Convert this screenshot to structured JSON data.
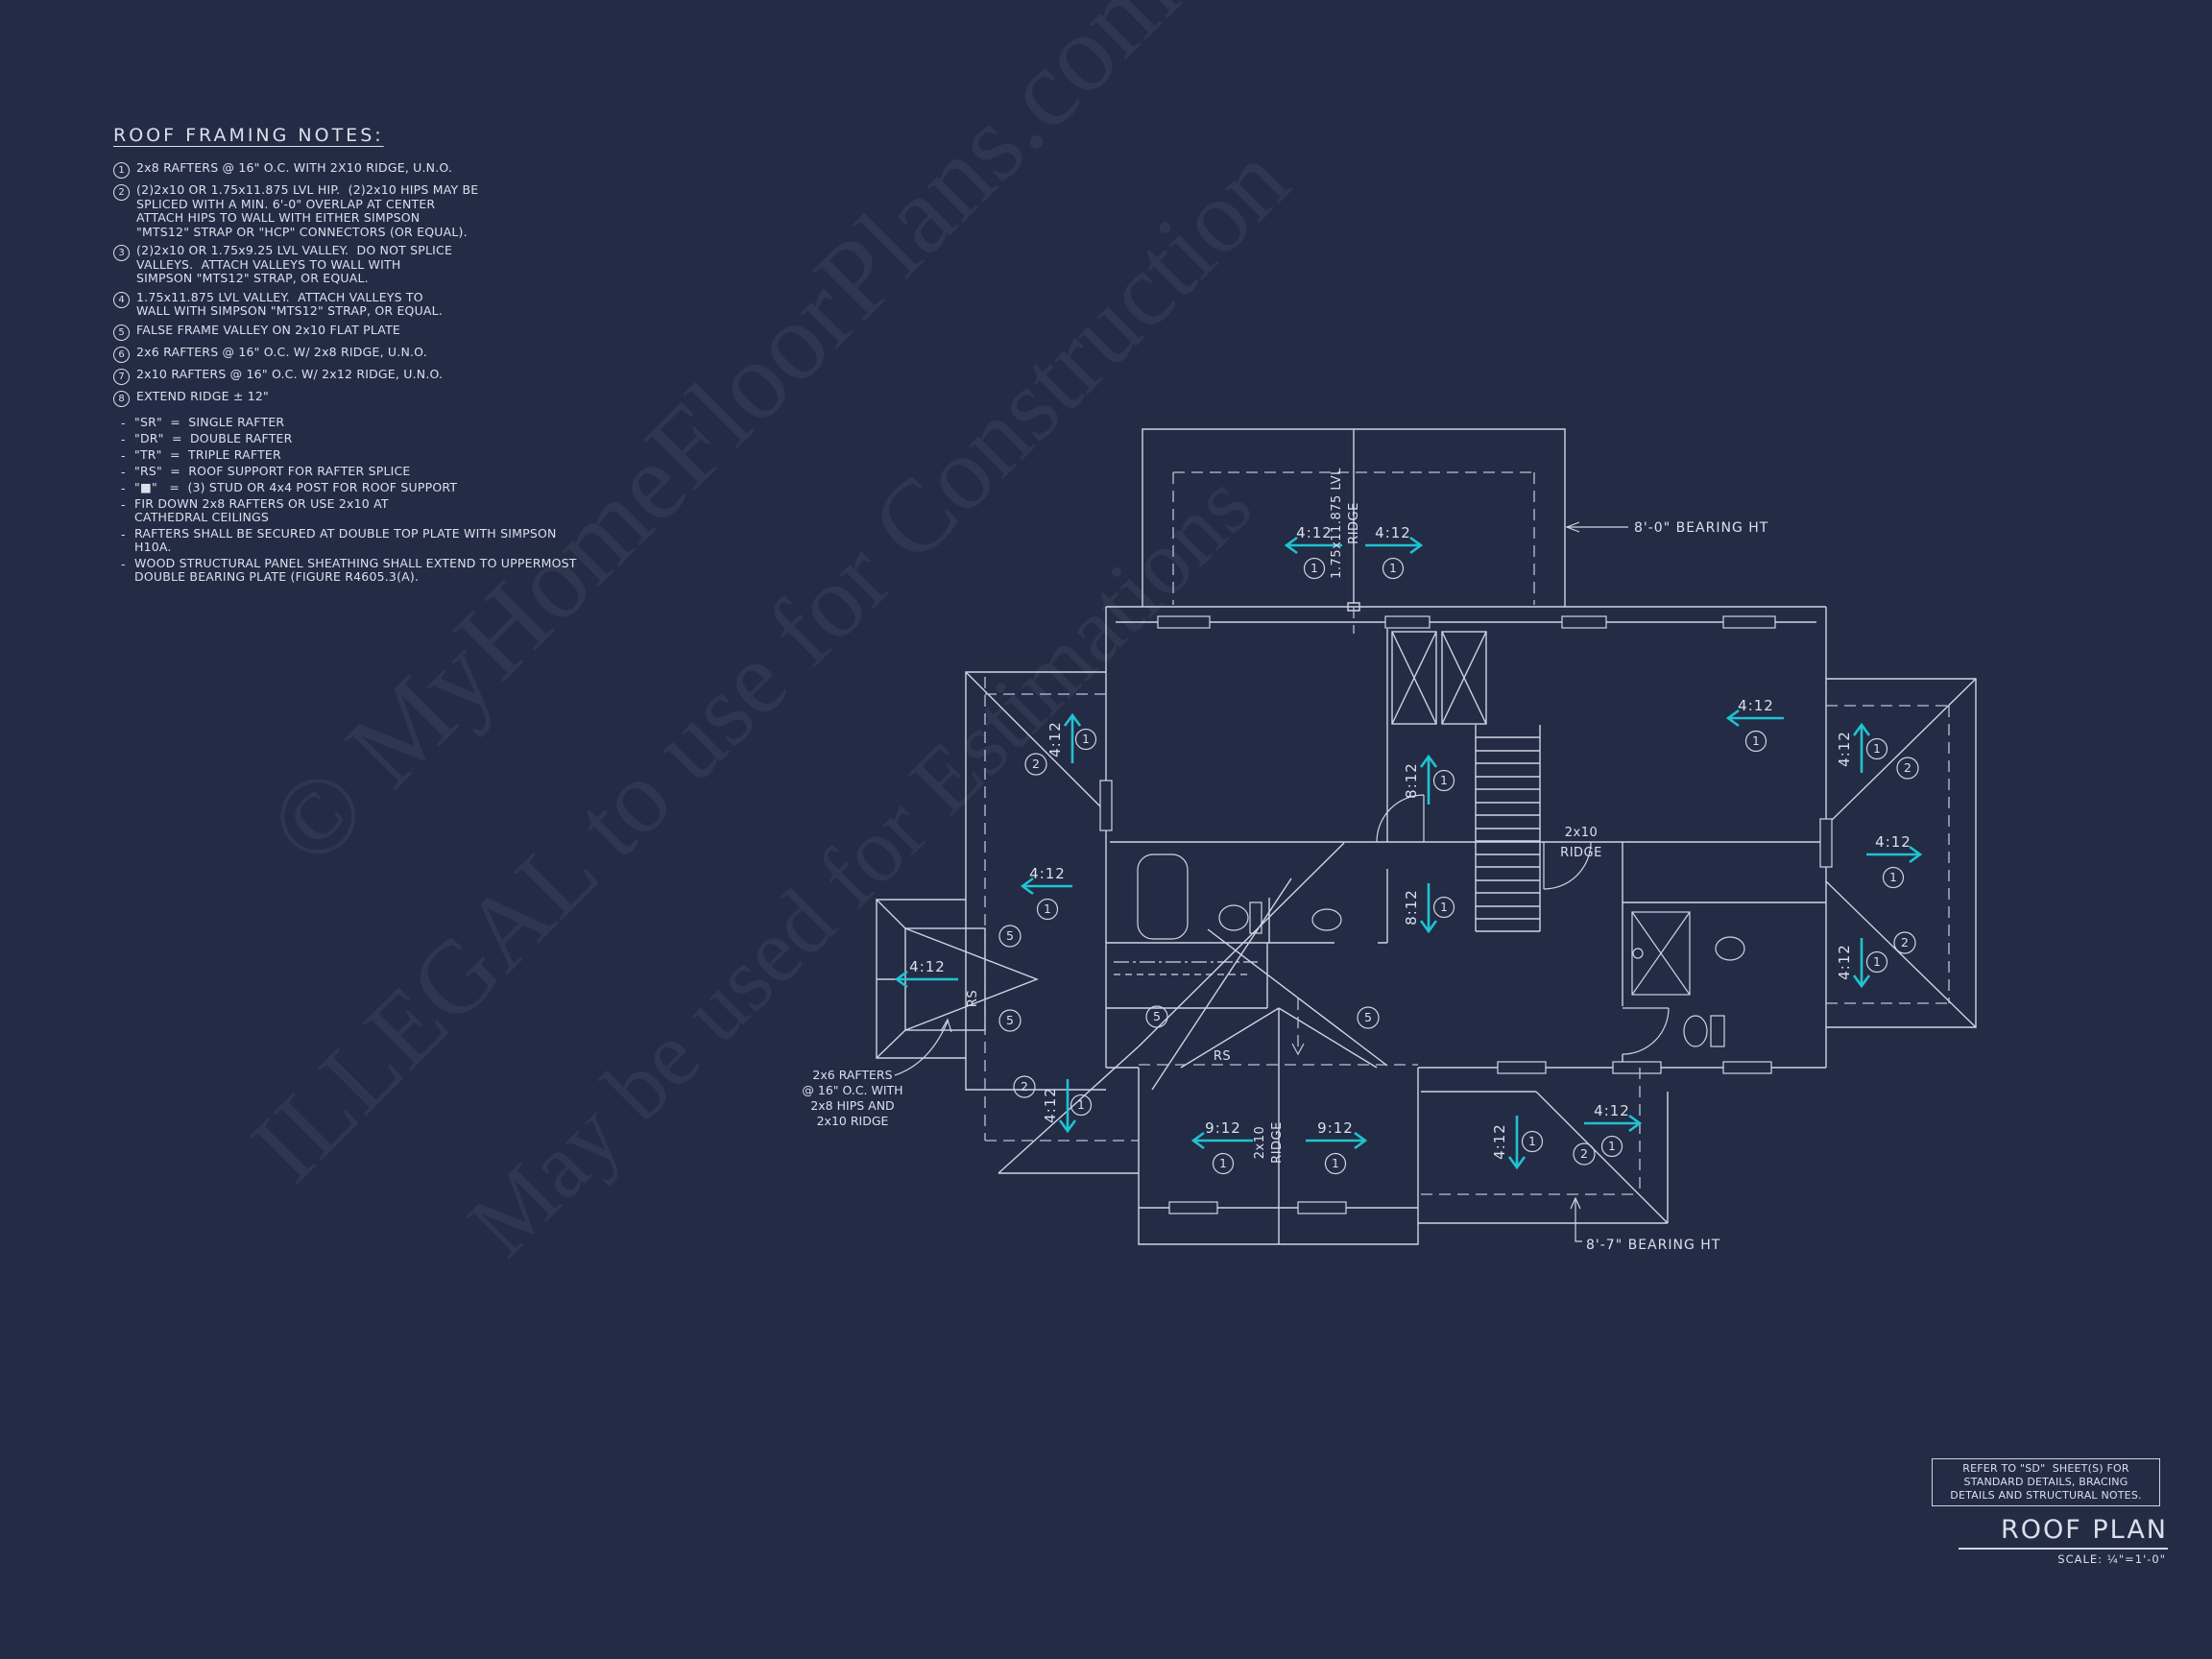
{
  "colors": {
    "background": "#242b44",
    "line": "#cdd5e3",
    "accent": "#1fc3d2",
    "text": "#d9e0ec"
  },
  "notes": {
    "title": "ROOF FRAMING NOTES:",
    "dash_prefix": "-",
    "items": [
      {
        "n": "1",
        "text": "2x8 RAFTERS @ 16\" O.C. WITH 2X10 RIDGE, U.N.O."
      },
      {
        "n": "2",
        "text": "(2)2x10 OR 1.75x11.875 LVL HIP.  (2)2x10 HIPS MAY BE\nSPLICED WITH A MIN. 6'-0\" OVERLAP AT CENTER\nATTACH HIPS TO WALL WITH EITHER SIMPSON\n\"MTS12\" STRAP OR \"HCP\" CONNECTORS (OR EQUAL)."
      },
      {
        "n": "3",
        "text": "(2)2x10 OR 1.75x9.25 LVL VALLEY.  DO NOT SPLICE\nVALLEYS.  ATTACH VALLEYS TO WALL WITH\nSIMPSON \"MTS12\" STRAP, OR EQUAL."
      },
      {
        "n": "4",
        "text": "1.75x11.875 LVL VALLEY.  ATTACH VALLEYS TO\nWALL WITH SIMPSON \"MTS12\" STRAP, OR EQUAL."
      },
      {
        "n": "5",
        "text": "FALSE FRAME VALLEY ON 2x10 FLAT PLATE"
      },
      {
        "n": "6",
        "text": "2x6 RAFTERS @ 16\" O.C. W/ 2x8 RIDGE, U.N.O."
      },
      {
        "n": "7",
        "text": "2x10 RAFTERS @ 16\" O.C. W/ 2x12 RIDGE, U.N.O."
      },
      {
        "n": "8",
        "text": "EXTEND RIDGE ± 12\""
      }
    ],
    "dash_items": [
      "\"SR\"  =  SINGLE RAFTER",
      "\"DR\"  =  DOUBLE RAFTER",
      "\"TR\"  =  TRIPLE RAFTER",
      "\"RS\"  =  ROOF SUPPORT FOR RAFTER SPLICE",
      "\"■\"   =  (3) STUD OR 4x4 POST FOR ROOF SUPPORT",
      "FIR DOWN 2x8 RAFTERS OR USE 2x10 AT\nCATHEDRAL CEILINGS",
      "RAFTERS SHALL BE SECURED AT DOUBLE TOP PLATE WITH SIMPSON\nH10A.",
      "WOOD STRUCTURAL PANEL SHEATHING SHALL EXTEND TO UPPERMOST\nDOUBLE BEARING PLATE (FIGURE R4605.3(A)."
    ]
  },
  "plan": {
    "ridge_top": {
      "line1": "1.75x11.875 LVL",
      "line2": "RIDGE"
    },
    "ridge_main": {
      "line1": "2x10",
      "line2": "RIDGE"
    },
    "ridge_gable": {
      "line1": "2x10",
      "line2": "RIDGE"
    },
    "bearing_top": "8'-0\" BEARING HT",
    "bearing_bottom": "8'-7\" BEARING HT",
    "rs_bay": "RS",
    "rs_gable": "RS",
    "rafter_note": "2x6 RAFTERS\n@ 16\" O.C. WITH\n2x8 HIPS AND\n2x10 RIDGE",
    "arrows": [
      {
        "slope": "4:12",
        "note": "1"
      },
      {
        "slope": "4:12",
        "note": "1"
      },
      {
        "slope": "4:12",
        "note": "1"
      },
      {
        "slope": "4:12",
        "note": "1"
      },
      {
        "slope": "4:12",
        "note": "1"
      },
      {
        "slope": "4:12",
        "note": ""
      },
      {
        "slope": "4:12",
        "note": "1"
      },
      {
        "slope": "8:12",
        "note": "1"
      },
      {
        "slope": "8:12",
        "note": "1"
      },
      {
        "slope": "9:12",
        "note": "1"
      },
      {
        "slope": "9:12",
        "note": "1"
      },
      {
        "slope": "4:12",
        "note": "1"
      },
      {
        "slope": "4:12",
        "note": "1"
      },
      {
        "slope": "4:12",
        "note": "1"
      },
      {
        "slope": "4:12",
        "note": "1"
      },
      {
        "slope": "4:12",
        "note": "1"
      }
    ],
    "hip_callouts": [
      "2",
      "2",
      "2",
      "2",
      "2",
      "5",
      "5",
      "5",
      "5"
    ]
  },
  "titleblock": {
    "box_note": "REFER TO \"SD\"  SHEET(S) FOR\nSTANDARD DETAILS, BRACING\nDETAILS AND STRUCTURAL NOTES.",
    "title": "ROOF PLAN",
    "scale": "SCALE: ¼\"=1'-0\""
  },
  "watermark": {
    "line1": "© MyHomeFloorPlans.com",
    "line2": "ILLEGAL to use for Construction",
    "line3": "May be used for Estimations"
  }
}
